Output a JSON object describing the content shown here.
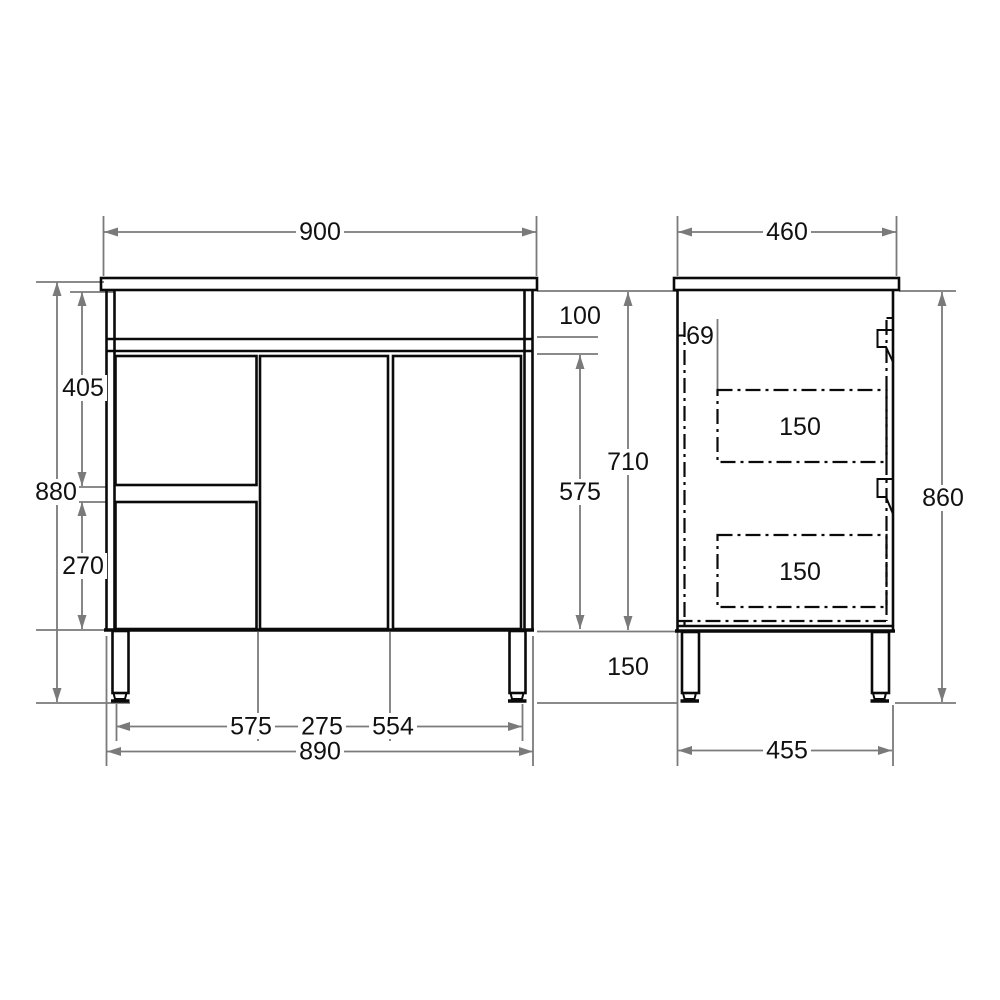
{
  "drawing": {
    "type": "furniture-dimension-diagram",
    "unit_values_visible_only": true,
    "colors": {
      "line": "#0a0a0a",
      "dimension": "#7a7a7a",
      "text": "#111111",
      "background": "#ffffff"
    },
    "views": {
      "front": {
        "dims": {
          "width": "900",
          "apron_height": "100",
          "door_height": "575",
          "total_height": "880",
          "upper_drawer_height": "405",
          "lower_drawer_height": "270",
          "base_span_left": "575",
          "base_span_mid": "275",
          "base_span_right": "554",
          "base_width": "890"
        }
      },
      "side": {
        "dims": {
          "depth": "460",
          "panel_offset": "69",
          "carcass_height": "710",
          "drawer1_height": "150",
          "drawer2_height": "150",
          "leg_height": "150",
          "total_height": "860",
          "base_depth": "455"
        }
      }
    }
  }
}
